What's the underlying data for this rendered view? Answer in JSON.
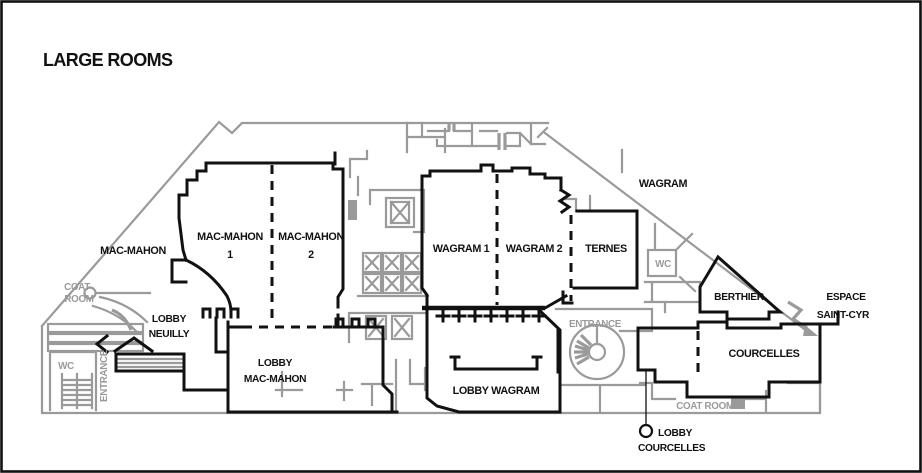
{
  "title": "LARGE ROOMS",
  "colors": {
    "wall": "#111111",
    "detail": "#9a9a9a"
  },
  "rooms": {
    "mac_mahon_outside": "MAC-MAHON",
    "mac_mahon_1_line1": "MAC-MAHON",
    "mac_mahon_1_line2": "1",
    "mac_mahon_2_line1": "MAC-MAHON",
    "mac_mahon_2_line2": "2",
    "wagram_1": "WAGRAM 1",
    "wagram_2": "WAGRAM 2",
    "ternes": "TERNES",
    "wagram_street": "WAGRAM",
    "berthier": "BERTHIER",
    "espace_line1": "ESPACE",
    "espace_line2": "SAINT-CYR",
    "courcelles": "COURCELLES"
  },
  "lobbies": {
    "neuilly_line1": "LOBBY",
    "neuilly_line2": "NEUILLY",
    "mac_mahon_line1": "LOBBY",
    "mac_mahon_line2": "MAC-MAHON",
    "wagram": "LOBBY WAGRAM",
    "courcelles_line1": "LOBBY",
    "courcelles_line2": "COURCELLES"
  },
  "facilities": {
    "coat_room_left_line1": "COAT",
    "coat_room_left_line2": "ROOM",
    "coat_room_right": "COAT ROOM",
    "wc_left": "WC",
    "wc_right": "WC",
    "entrance_left": "ENTRANCE",
    "entrance_center": "ENTRANCE"
  }
}
